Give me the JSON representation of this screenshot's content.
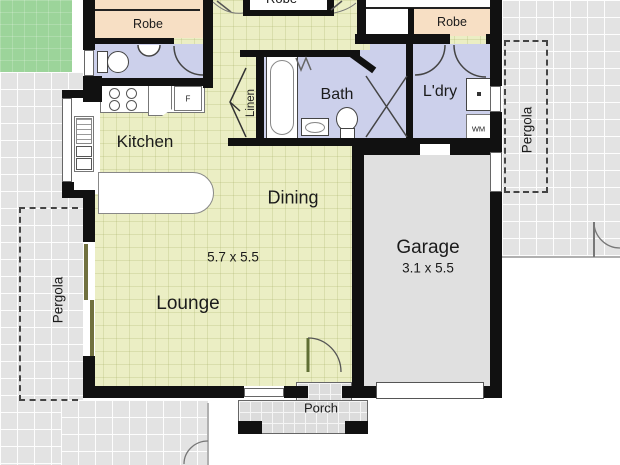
{
  "plan": {
    "rooms": {
      "kitchen": {
        "label": "Kitchen"
      },
      "dining": {
        "label": "Dining"
      },
      "lounge": {
        "label": "Lounge",
        "dimensions": "5.7 x 5.5"
      },
      "garage": {
        "label": "Garage",
        "dimensions": "3.1 x 5.5"
      },
      "bath": {
        "label": "Bath"
      },
      "laundry": {
        "label": "L'dry"
      },
      "linen": {
        "label": "Linen"
      },
      "porch": {
        "label": "Porch"
      },
      "robe_left": {
        "label": "Robe"
      },
      "robe_center": {
        "label": "Robe"
      },
      "robe_right": {
        "label": "Robe"
      }
    },
    "outdoor": {
      "pergola_left": {
        "label": "Pergola"
      },
      "pergola_right": {
        "label": "Pergola"
      }
    },
    "appliances": {
      "fridge_abbrev": "F",
      "washing_machine_abbrev": "WM"
    },
    "colors": {
      "wall": "#111111",
      "living_fill": "#ebeec4",
      "wet_area_fill": "#ccd0eb",
      "robe_fill": "#f7dfc4",
      "garage_fill": "#e0e0e0",
      "paving_fill": "#e3e3e3",
      "grass_fill": "#9cd49a"
    }
  }
}
